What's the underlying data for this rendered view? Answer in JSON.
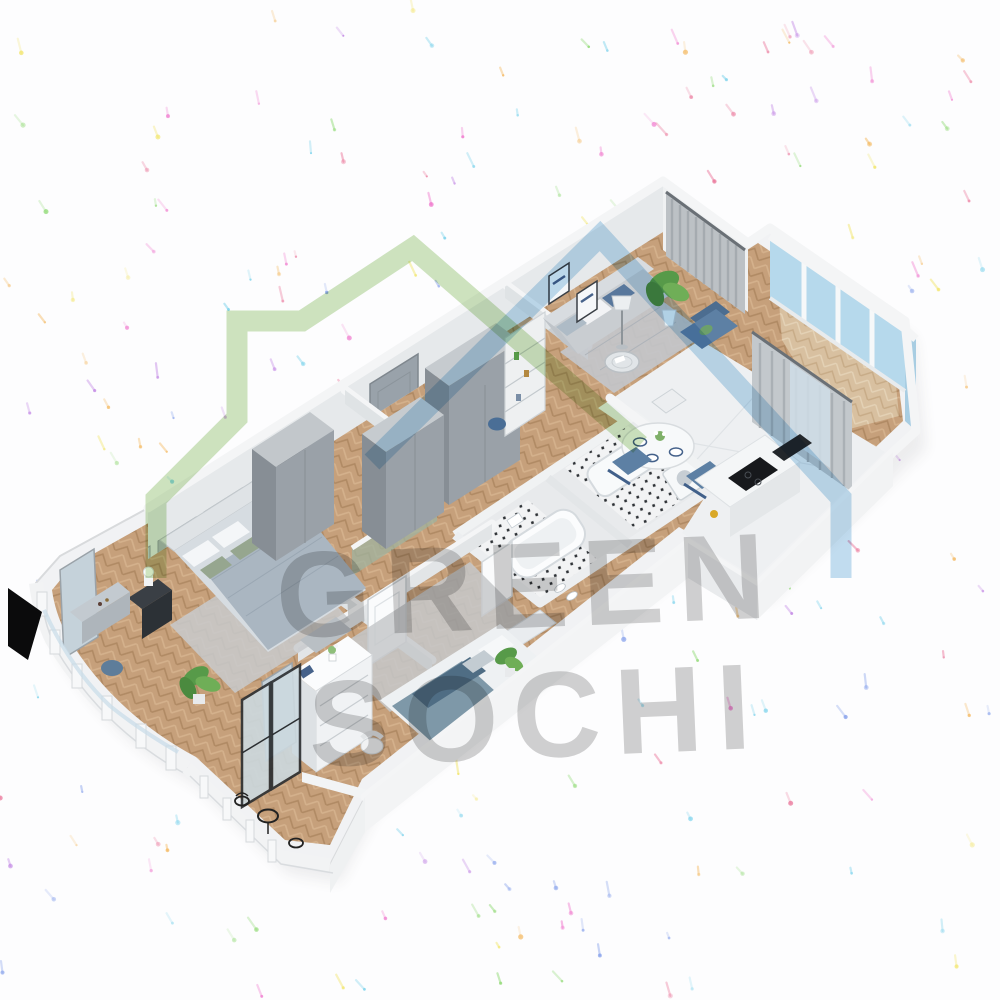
{
  "watermark": {
    "line1": "GREEN",
    "line2": "SOCHI",
    "color": "#8c8c8c",
    "opacity": 0.4
  },
  "logo": {
    "green_house_color": "#86bb5f",
    "blue_roof_color": "#7ab5dd",
    "green_opacity": 0.4,
    "blue_opacity": 0.45
  },
  "confetti": {
    "count": 240,
    "colors": [
      "#ee5fc4",
      "#b66fe0",
      "#f0e14f",
      "#7fd45f",
      "#5fc9e8",
      "#6f8fe8",
      "#f2a93c",
      "#e8608a"
    ]
  },
  "palette": {
    "background": "#fdfdfe",
    "wall_top": "#f4f5f6",
    "wall_face": "#e6e9eb",
    "living_wall": "#adbab5",
    "wood_floor": "#c6a07b",
    "marble_floor": "#eef0f2",
    "mosaic_dark": "#2e3236",
    "rug_gray": "#c5c7ca",
    "sofa_gray": "#ccd0d4",
    "accent_blue": "#5b7fa3",
    "glass_blue": "#b6d9ec",
    "plant_green": "#579a49",
    "cooktop_black": "#17191c",
    "wardrobe_gray": "#9aa1a8"
  },
  "scene": {
    "kind": "isometric 3D floor plan render",
    "rooms": [
      "master-bedroom",
      "bay-balcony",
      "hallway",
      "kids-bedroom",
      "kids-balcony",
      "bathroom-1",
      "bathroom-2",
      "living-room",
      "kitchen-dining",
      "glazed-loggia"
    ]
  }
}
